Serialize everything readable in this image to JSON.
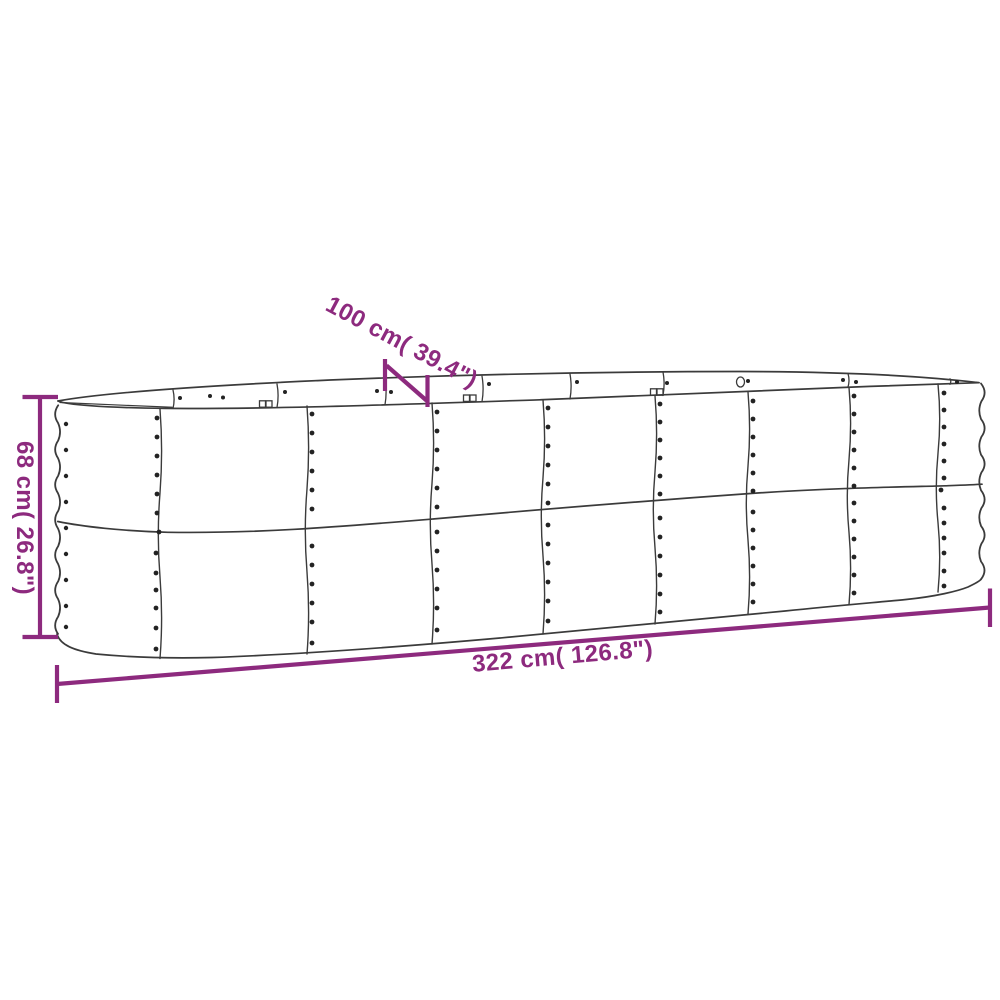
{
  "figure": {
    "type": "product-dimension-diagram",
    "subject": "oval-metal-raised-garden-bed",
    "background_color": "#ffffff",
    "accent_color": "#8d2a7e",
    "outline_color": "#3b3b3b",
    "rivet_color": "#232323",
    "dimensions": {
      "depth_label": "100 cm( 39.4\")",
      "height_label": "68 cm( 26.8\")",
      "length_label": "322 cm( 126.8\")"
    }
  }
}
